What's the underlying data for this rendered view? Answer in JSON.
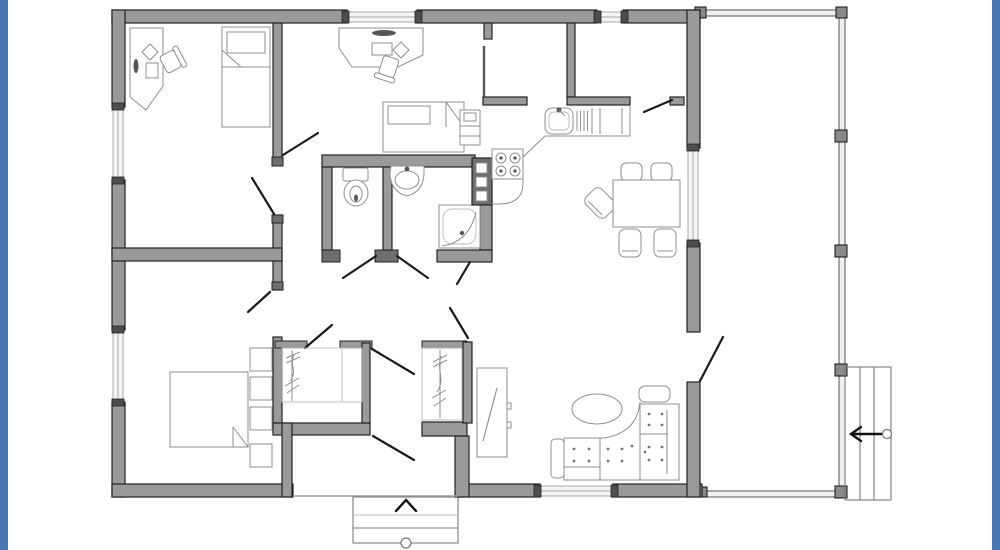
{
  "page": {
    "type": "house floor plan drawing",
    "background": "#ffffff",
    "has_text_labels": false
  },
  "colors": {
    "page_bg": "#ffffff",
    "frame_blue": "#4b76b4",
    "wall_fill": "#9a9a9a",
    "wall_dark_fill": "#6e6e6e",
    "wall_outline": "#222222",
    "window_fill": "#f4f4f4",
    "window_line": "#aaaaaa",
    "window_cap": "#4d4d4d",
    "door_line": "#1a1a1a",
    "furniture_line": "#8f8f8f",
    "furniture_line_light": "#bbbbbb",
    "deck_line": "#555555"
  },
  "floorplan": {
    "description": "Single-storey house plan: two bedrooms/office at top-left, master bedroom bottom-left, central bathroom block (WC, basin room, shower), kitchen with L-counter, dining set, living room with sectional sofa, entry hall with two closets, side deck with railing and stairs, front entry steps",
    "rooms": [
      {
        "name": "office",
        "furniture": [
          "corner-desk",
          "desk-chair",
          "single-bed"
        ]
      },
      {
        "name": "small-bedroom",
        "furniture": [
          "desk",
          "desk-chair",
          "single-bed",
          "bedside-shelf"
        ]
      },
      {
        "name": "wc",
        "furniture": [
          "toilet"
        ]
      },
      {
        "name": "washroom",
        "furniture": [
          "wash-basin"
        ]
      },
      {
        "name": "shower-room",
        "furniture": [
          "corner-shower"
        ]
      },
      {
        "name": "kitchen",
        "furniture": [
          "l-shaped-counter",
          "sink-with-drainer",
          "four-burner-stove",
          "utility-column-3-compartments"
        ]
      },
      {
        "name": "dining-area",
        "furniture": [
          "dining-table",
          "five-chairs"
        ]
      },
      {
        "name": "living-room",
        "furniture": [
          "l-shaped-sectional-sofa",
          "oval-coffee-table",
          "tall-mirror-cabinet"
        ]
      },
      {
        "name": "master-bedroom",
        "furniture": [
          "double-bed",
          "headboard-shelf-4-compartments"
        ]
      },
      {
        "name": "entry-hall",
        "furniture": [
          "closet-with-hangers",
          "closet-with-hangers"
        ]
      }
    ],
    "windows_count": 6,
    "doors_count": 12,
    "exterior_features": [
      "deck-with-railing-and-posts",
      "deck-stairs-with-left-direction-arrow",
      "entry-porch-steps-with-up-arrow"
    ]
  }
}
